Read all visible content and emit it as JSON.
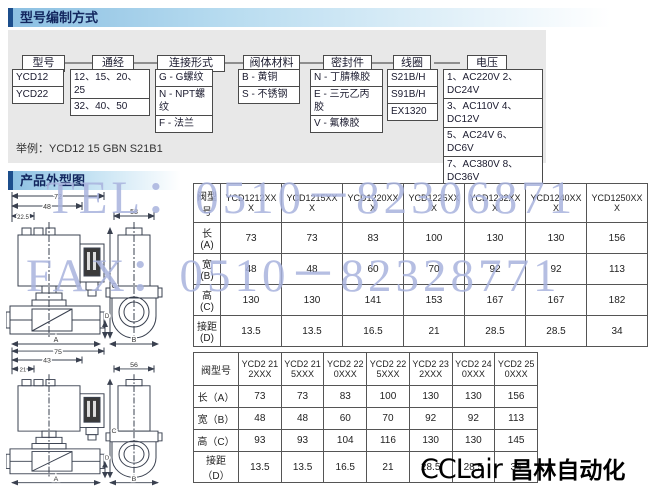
{
  "header1": {
    "title": "型号编制方式"
  },
  "header2": {
    "title": "产品外型图"
  },
  "accent_colors": {
    "header_bar": "#1c4e8c",
    "header_gradient": "#8cc0e2",
    "watermark": "#a9b3de",
    "panel_bg": "#e8e8e8"
  },
  "flow": {
    "nodes": [
      {
        "label": "型号",
        "options": [
          "YCD12",
          "YCD22"
        ]
      },
      {
        "label": "通经",
        "options": [
          "12、15、20、25",
          "32、40、50"
        ]
      },
      {
        "label": "连接形式",
        "options": [
          "G - G螺纹",
          "N - NPT螺纹",
          "F - 法兰"
        ]
      },
      {
        "label": "阀体材料",
        "options": [
          "B - 黄铜",
          "S - 不锈钢"
        ]
      },
      {
        "label": "密封件",
        "options": [
          "N - 丁腈橡胶",
          "E - 三元乙丙胶",
          "V - 氟橡胶"
        ]
      },
      {
        "label": "线圈",
        "options": [
          "S21B/H",
          "S91B/H",
          "EX1320"
        ]
      },
      {
        "label": "电压",
        "options": [
          "1、AC220V 2、DC24V",
          "3、AC110V 4、DC12V",
          "5、AC24V 6、DC6V",
          "7、AC380V 8、DC36V",
          "9、AC36V"
        ]
      }
    ],
    "example": "举例：YCD12 15 GBN  S21B1"
  },
  "watermarks": {
    "tel": "TEL：0510－82306871",
    "fax": "FAX：0510－82328771"
  },
  "table1": {
    "corner": "阀型号",
    "columns": [
      "YCD1212XXX",
      "YCD1215XXX",
      "YCD1220XXX",
      "YCD1225XXX",
      "YCD1232XXX",
      "YCD1240XXX",
      "YCD1250XXX"
    ],
    "rows": [
      {
        "label": "长(A)",
        "values": [
          "73",
          "73",
          "83",
          "100",
          "130",
          "130",
          "156"
        ]
      },
      {
        "label": "宽(B)",
        "values": [
          "48",
          "48",
          "60",
          "70",
          "92",
          "92",
          "113"
        ]
      },
      {
        "label": "高(C)",
        "values": [
          "130",
          "130",
          "141",
          "153",
          "167",
          "167",
          "182"
        ]
      },
      {
        "label": "接距(D)",
        "values": [
          "13.5",
          "13.5",
          "16.5",
          "21",
          "28.5",
          "28.5",
          "34"
        ]
      }
    ]
  },
  "table2": {
    "corner": "阀型号",
    "columns": [
      "YCD2 212XXX",
      "YCD2 215XXX",
      "YCD2 220XXX",
      "YCD2 225XXX",
      "YCD2 232XXX",
      "YCD2 240XXX",
      "YCD2 250XXX"
    ],
    "rows": [
      {
        "label": "长（A）",
        "values": [
          "73",
          "73",
          "83",
          "100",
          "130",
          "130",
          "156"
        ]
      },
      {
        "label": "宽（B）",
        "values": [
          "48",
          "48",
          "60",
          "70",
          "92",
          "92",
          "113"
        ]
      },
      {
        "label": "高（C）",
        "values": [
          "93",
          "93",
          "104",
          "116",
          "130",
          "130",
          "145"
        ]
      },
      {
        "label": "接距（D）",
        "values": [
          "13.5",
          "13.5",
          "16.5",
          "21",
          "28.5",
          "28.5",
          "34"
        ]
      }
    ]
  },
  "drawing1": {
    "top_width": "72",
    "coil_width": "48",
    "offset": "22.5",
    "side_width": "58",
    "height_label": "C",
    "length_label": "A",
    "side_length_label": "B",
    "gap_label": "D"
  },
  "drawing2": {
    "top_width": "75",
    "coil_width": "43",
    "offset": "21",
    "side_width": "56",
    "height_label": "C",
    "length_label": "A",
    "side_length_label": "B",
    "gap_label": "D"
  },
  "footer": {
    "brand": "CCLair",
    "company": "昌林自动化"
  }
}
